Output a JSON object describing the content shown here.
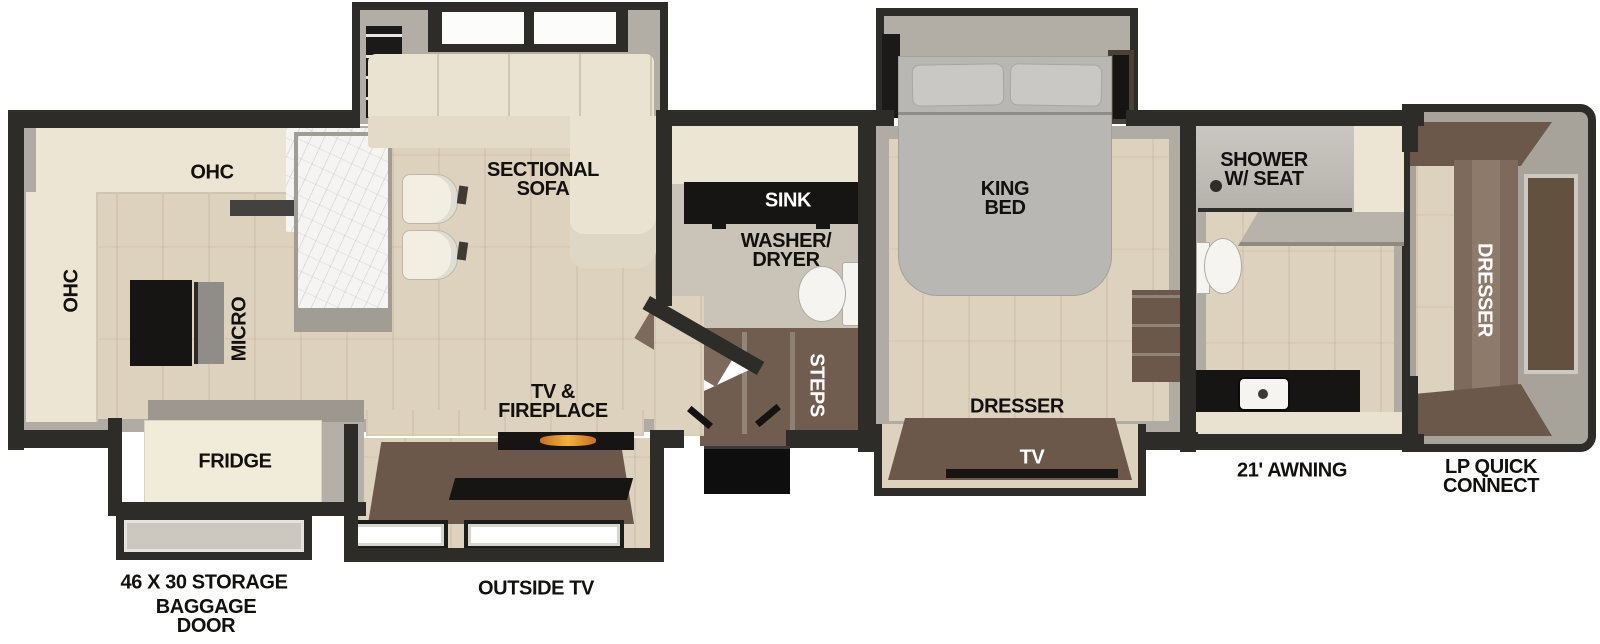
{
  "labels": {
    "ohc_top": "OHC",
    "ohc_left": "OHC",
    "micro": "MICRO",
    "fridge": "FRIDGE",
    "sectional_sofa": "SECTIONAL\nSOFA",
    "tv_fireplace": "TV &\nFIREPLACE",
    "sink": "SINK",
    "washer_dryer": "WASHER/\nDRYER",
    "steps": "STEPS",
    "king_bed": "KING\nBED",
    "dresser_bedroom": "DRESSER",
    "tv_bedroom": "TV",
    "shower": "SHOWER\nW/ SEAT",
    "dresser_front": "DRESSER",
    "storage": "46 X 30 STORAGE",
    "baggage_door": "BAGGAGE\nDOOR",
    "outside_tv": "OUTSIDE TV",
    "awning": "21' AWNING",
    "lp_quick_connect": "LP QUICK\nCONNECT"
  },
  "colors": {
    "wall": "#2e2c29",
    "floor": "#ddd2bd",
    "bath_floor": "#c9c4b7",
    "cabinet_cream": "#ece5d3",
    "furniture_brown": "#6b584a",
    "appliance_black": "#161514",
    "slide_interior": "#b2aea5"
  }
}
